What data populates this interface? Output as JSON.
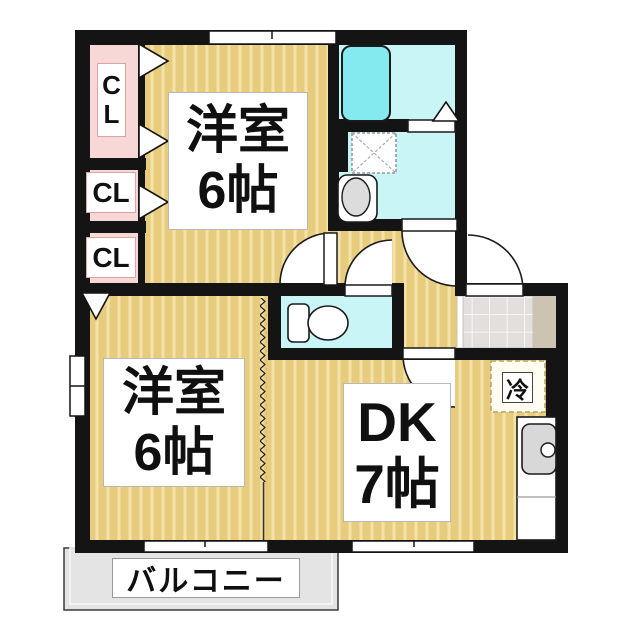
{
  "plan": {
    "type": "apartment-floor-plan",
    "rooms": {
      "bedroom_top": {
        "name": "洋室",
        "size": "6帖"
      },
      "bedroom_left": {
        "name": "洋室",
        "size": "6帖"
      },
      "dining_kitchen": {
        "name": "DK",
        "size": "7帖"
      },
      "balcony": {
        "label": "バルコニー"
      },
      "closet_tall": {
        "letters": [
          "C",
          "L"
        ]
      },
      "closet_mid": {
        "label": "CL"
      },
      "closet_low": {
        "label": "CL"
      },
      "refrigerator": {
        "label": "冷"
      }
    },
    "colors": {
      "floor_tan": "#e8cc7e",
      "floor_stripe": "#f3e3ab",
      "closet_pink": "#f8d7d7",
      "wet_area_cyan": "#c9f5f7",
      "bathtub_cyan": "#85e9f0",
      "wall_black": "#141414",
      "entry_tile_gray": "#e2dfdc",
      "entry_step_beige": "#ccc3b0",
      "balcony_gray": "#e4e4e4",
      "sink_gray": "#d8d8d8"
    }
  }
}
